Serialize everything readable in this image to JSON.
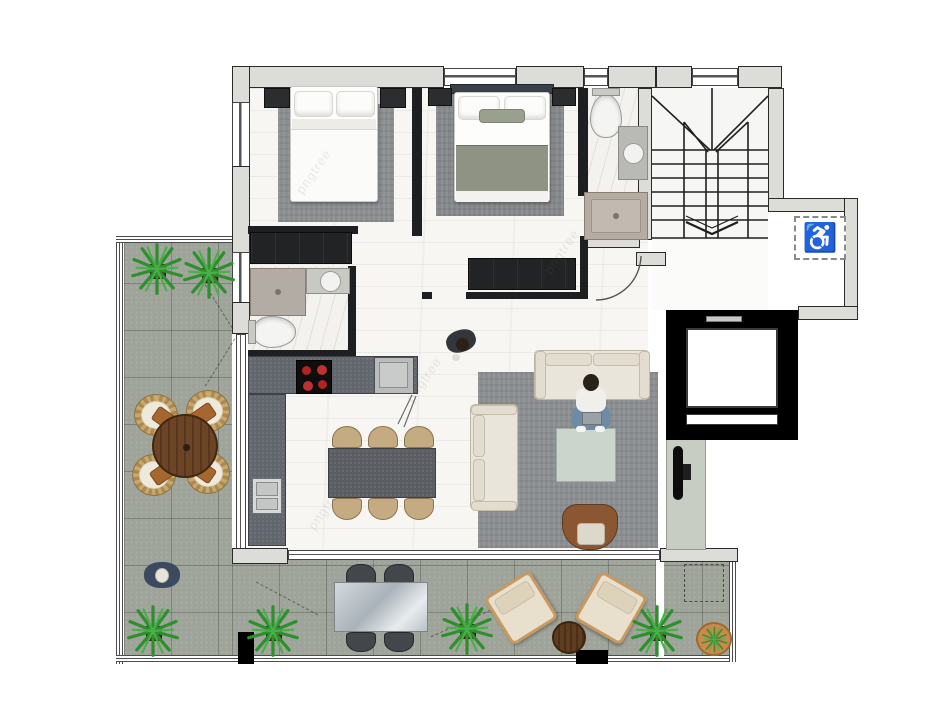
{
  "watermark": {
    "text": "pngtree"
  },
  "icons": {
    "accessible": "♿"
  },
  "palette": {
    "exterior_wall": "#dcdcd9",
    "wall_edge": "#2b2b2b",
    "interior_wall": "#1e1f20",
    "wood_floor": "#f7f6f3",
    "marble_floor": "#f3f2ee",
    "terrace_tile": "#9fa49a",
    "rug_gray": "#8b8e90",
    "kitchen_counter": "#62666d",
    "stove_black": "#0e0e0e",
    "burner_red": "#b22222",
    "sofa_cream": "#e9e5da",
    "coffee_table_sage": "#ccd5cb",
    "armchair_brown": "#8a5732",
    "dining_chair_tan": "#c5ab81",
    "dining_table_gray": "#5a5e63",
    "wood_table_brown": "#5e3c1f",
    "bed_blanket_sage": "#8f9383",
    "bed_headboard_navy": "#3a4049",
    "shower_beige": "#b5ada2",
    "tv_wall_sage": "#c8cdc4",
    "elevator_black": "#000000",
    "lounger_cream": "#e8dfcd",
    "plant_green": "#2f8f2f",
    "terracotta_pot": "#c98a4b"
  }
}
